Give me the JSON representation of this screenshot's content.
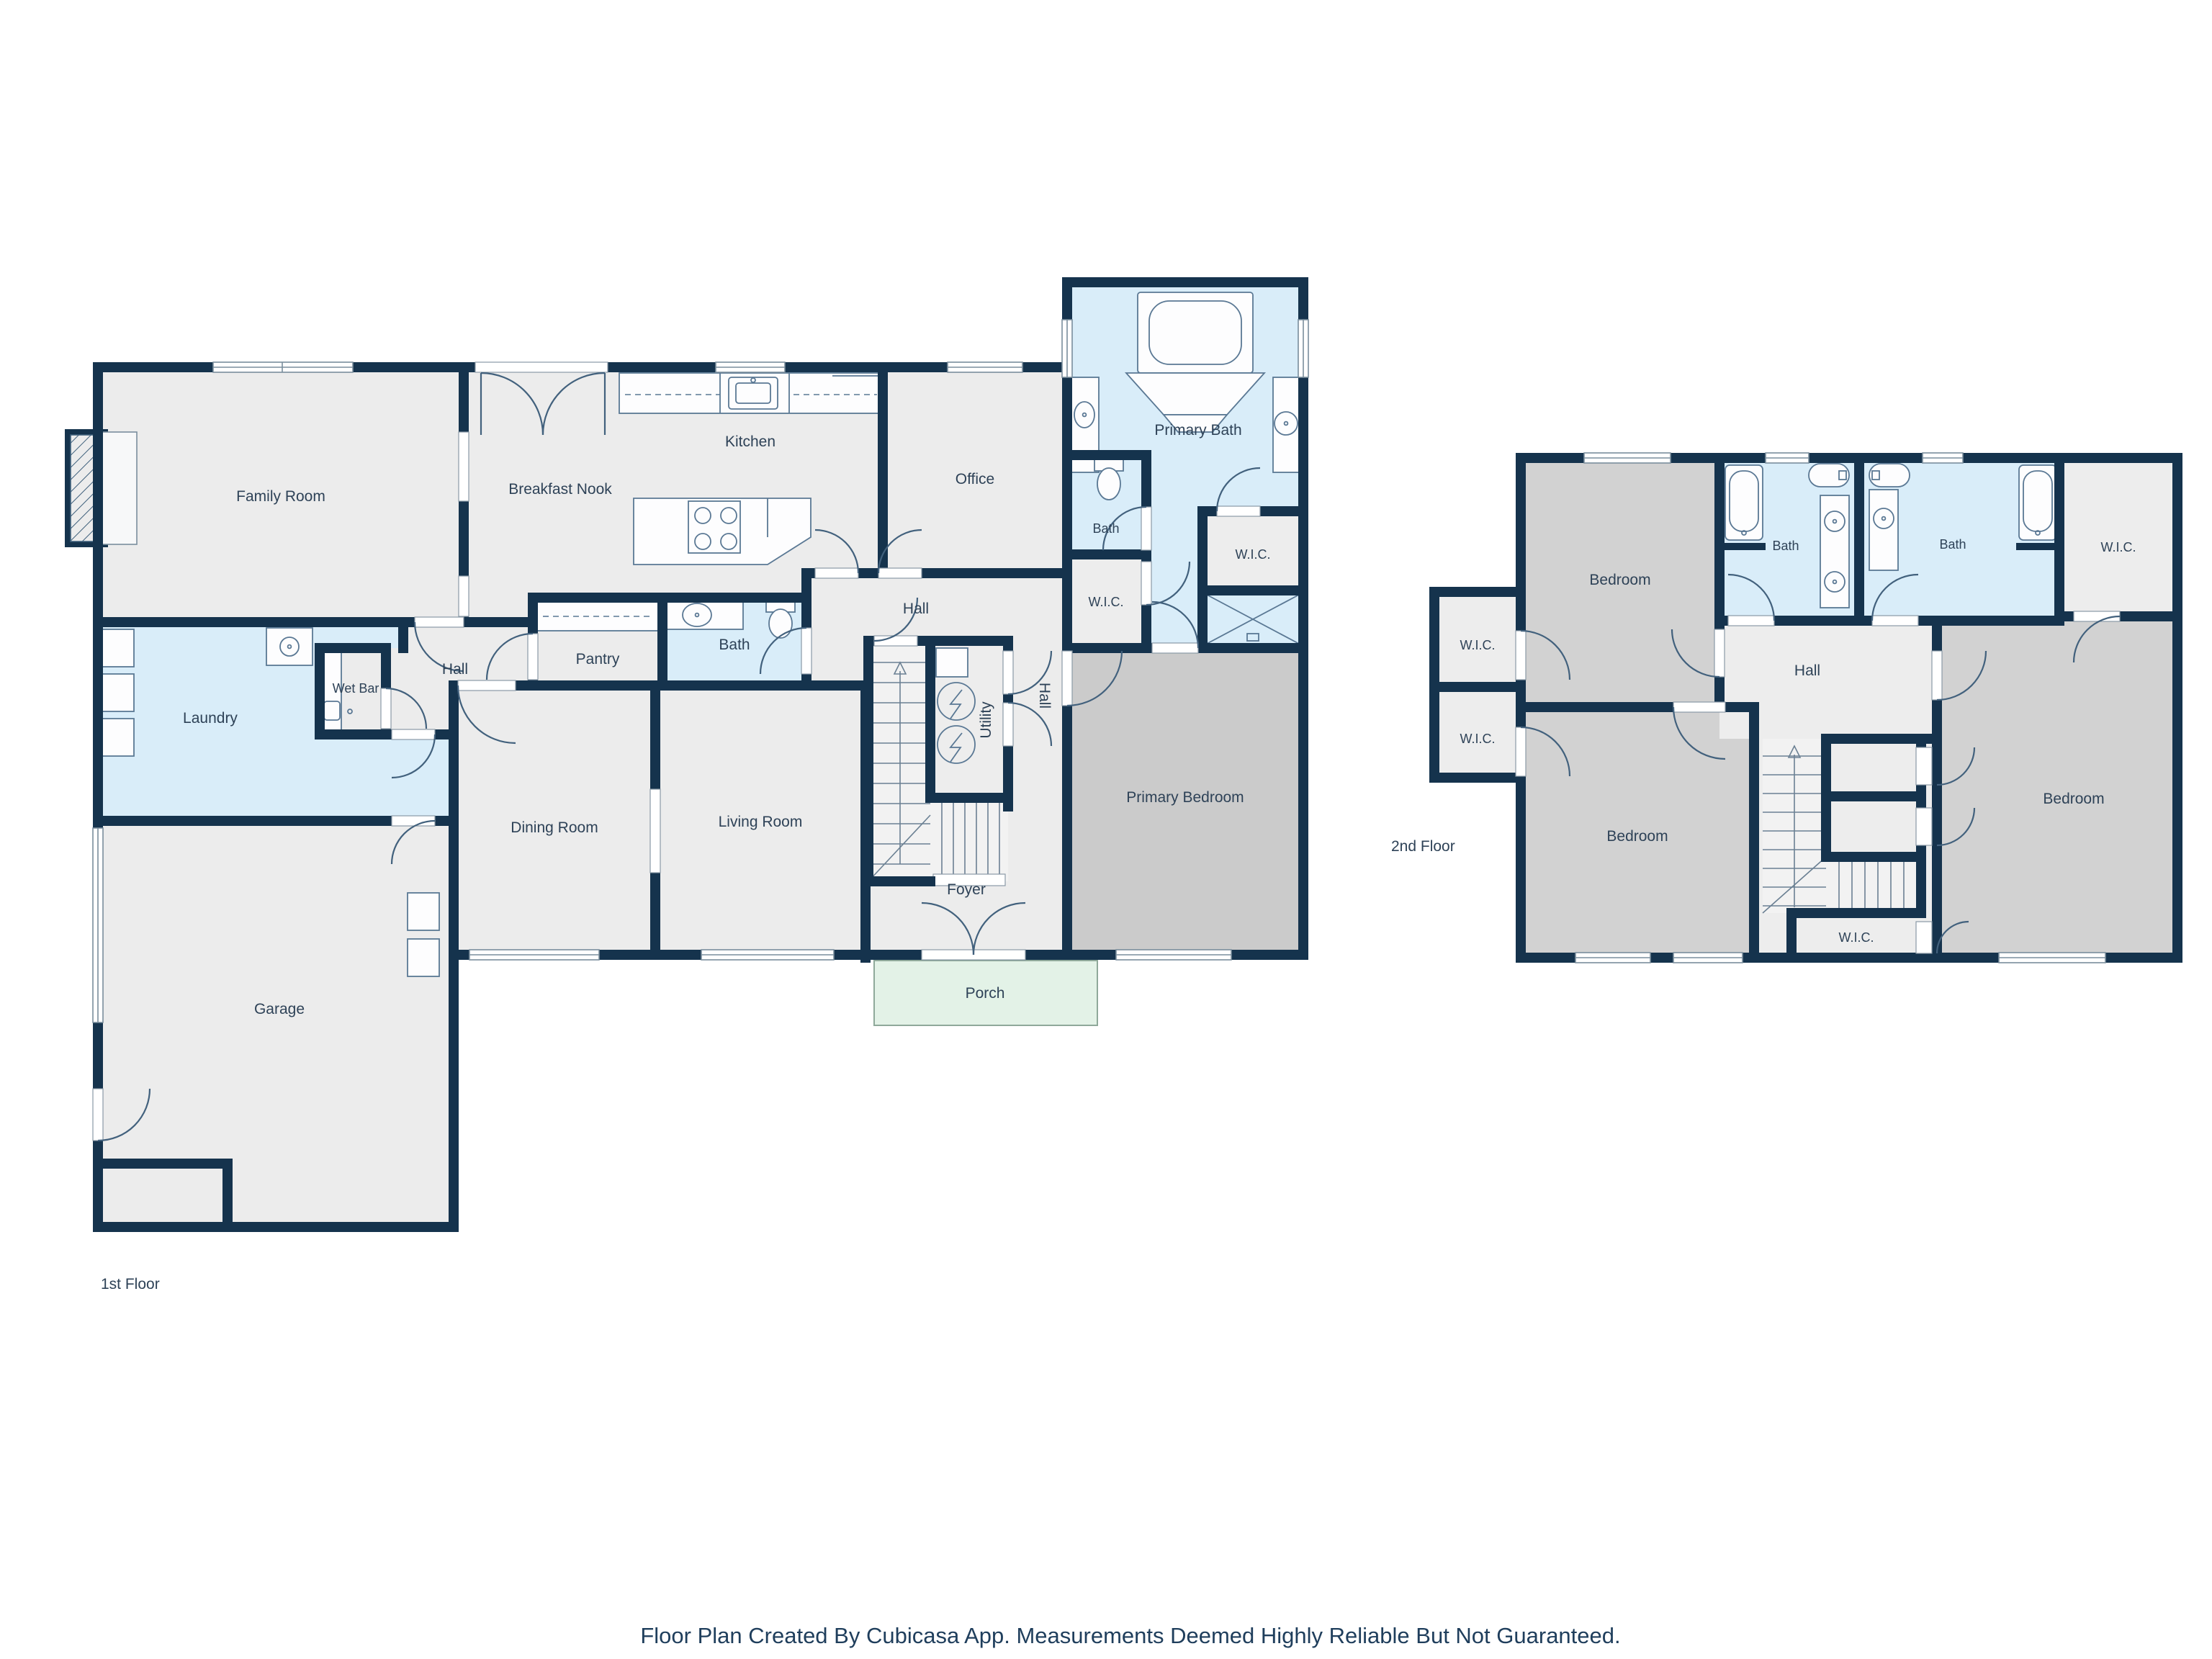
{
  "footer": "Floor Plan Created By Cubicasa App. Measurements Deemed Highly Reliable But Not Guaranteed.",
  "colors": {
    "wall": "#15334d",
    "room": "#ececec",
    "room_alt": "#ededed",
    "bedroom_primary": "#cbcbcb",
    "bedroom": "#d2d2d2",
    "bath": "#d9edf9",
    "porch": "#e3f2e7",
    "stairs": "#f2f2f2",
    "label_text": "#2e4257"
  },
  "floor1": {
    "label": "1st Floor",
    "family_room": "Family Room",
    "breakfast_nook": "Breakfast Nook",
    "kitchen": "Kitchen",
    "office": "Office",
    "primary_bath": "Primary Bath",
    "bath_small": "Bath",
    "wic_a": "W.I.C.",
    "wic_b": "W.I.C.",
    "hall_a": "Hall",
    "hall_b": "Hall",
    "hall_c": "Hall",
    "pantry": "Pantry",
    "bath": "Bath",
    "wet_bar": "Wet Bar",
    "laundry": "Laundry",
    "utility": "Utility",
    "dining_room": "Dining Room",
    "living_room": "Living Room",
    "foyer": "Foyer",
    "porch": "Porch",
    "garage": "Garage",
    "primary_bedroom": "Primary Bedroom"
  },
  "floor2": {
    "label": "2nd Floor",
    "bedroom_nw": "Bedroom",
    "bedroom_sw": "Bedroom",
    "bedroom_e": "Bedroom",
    "bath_w": "Bath",
    "bath_e": "Bath",
    "wic_ne": "W.I.C.",
    "wic_w1": "W.I.C.",
    "wic_w2": "W.I.C.",
    "wic_s": "W.I.C.",
    "hall": "Hall"
  }
}
